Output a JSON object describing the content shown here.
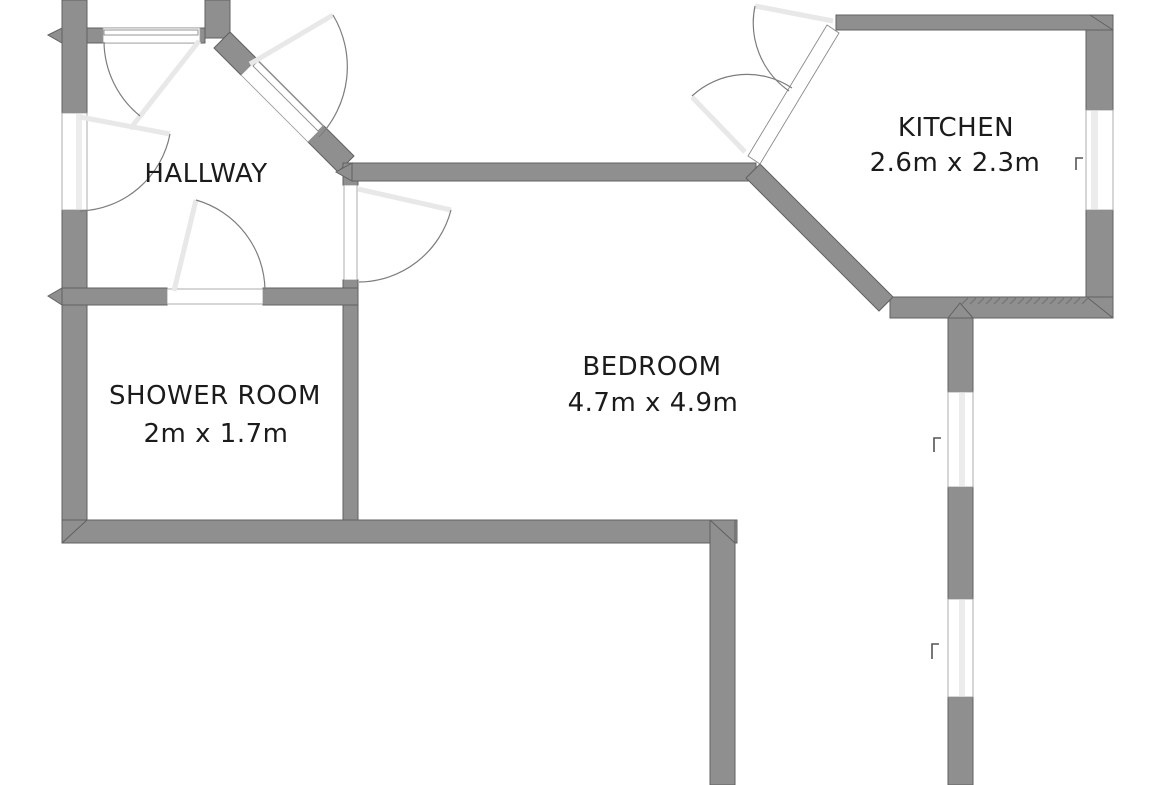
{
  "plan": {
    "type": "floor-plan",
    "rooms": {
      "hallway": {
        "label": "HALLWAY",
        "dimensions": ""
      },
      "kitchen": {
        "label": "KITCHEN",
        "dimensions": "2.6m x 2.3m"
      },
      "shower_room": {
        "label": "SHOWER ROOM",
        "dimensions": "2m x 1.7m"
      },
      "bedroom": {
        "label": "BEDROOM",
        "dimensions": "4.7m x 4.9m"
      }
    },
    "colors": {
      "wall_fill": "#8f8f8f",
      "wall_outline": "#616161",
      "background": "#ffffff",
      "window_fill": "#ffffff",
      "window_stripe": "#ececec",
      "door_swing_arc": "#7d7d7d",
      "door_leaf_faint": "#e8e8e8",
      "label_text": "#1b1b1b"
    }
  }
}
